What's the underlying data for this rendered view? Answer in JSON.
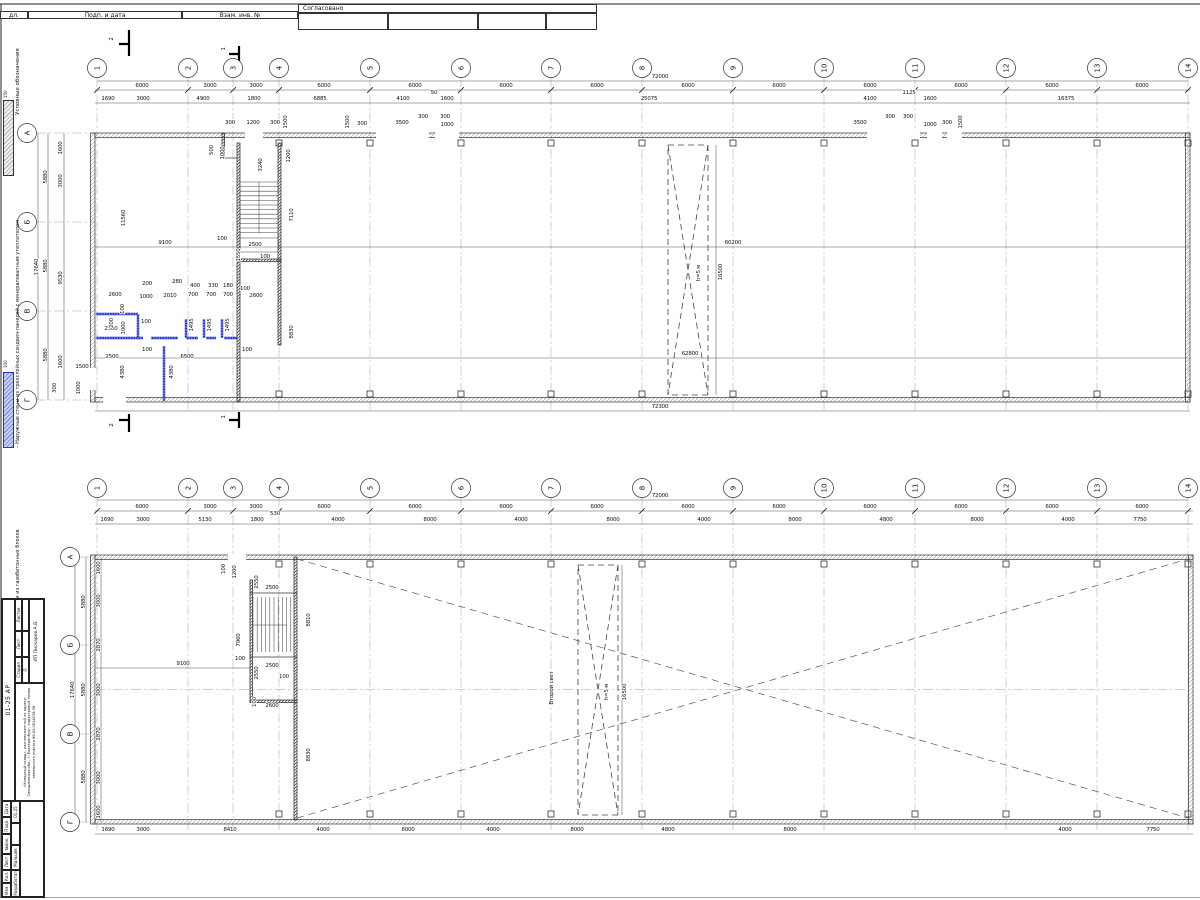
{
  "header": {
    "c1": "дл.",
    "c2": "Подп. и дата",
    "c3": "Взам. инв. №",
    "c4": "Согласовано"
  },
  "legend": {
    "title": "Условные обозначения",
    "item1": "– Наружные стены из трехслойных сэндвич-панелей с минераловатным утеплителем",
    "item2": "– Внутренние перегородки из газобетонных блоков",
    "t1": "150",
    "t2": "100",
    "blue": "#2330d8"
  },
  "titleblock": {
    "columns": [
      "Изм.",
      "Кол.",
      "Лист",
      "№док.",
      "Подп.",
      "Дата"
    ],
    "role": "Разработал",
    "name": "Мальцев",
    "date": "01.25",
    "doc_code": "01-25 АР",
    "project": "«Холодный склад», расположенный по адресу: Свердловская обл., г. Екатеринбург, кадастровый номер земельного участка 66:41:0614035:36",
    "client": "ИП Пискарев А.В.",
    "stage_label": "Стадия",
    "sheet_label": "Лист",
    "sheets_label": "Листов",
    "stage": "П"
  },
  "plan1": {
    "circles_top": [
      [
        "1",
        97,
        68
      ],
      [
        "2",
        188,
        68
      ],
      [
        "3",
        233,
        68
      ],
      [
        "4",
        279,
        68
      ],
      [
        "5",
        370,
        68
      ],
      [
        "6",
        461,
        68
      ],
      [
        "7",
        551,
        68
      ],
      [
        "8",
        642,
        68
      ],
      [
        "9",
        733,
        68
      ],
      [
        "10",
        824,
        68
      ],
      [
        "11",
        915,
        68
      ],
      [
        "12",
        1006,
        68
      ],
      [
        "13",
        1097,
        68
      ],
      [
        "14",
        1188,
        68
      ]
    ],
    "circles_left": [
      [
        "А",
        27,
        133
      ],
      [
        "Б",
        27,
        222
      ],
      [
        "В",
        27,
        311
      ],
      [
        "Г",
        27,
        400
      ]
    ],
    "total_top": [
      [
        "72000",
        660,
        78
      ]
    ],
    "dims1": [
      [
        "6000",
        142,
        87
      ],
      [
        "3000",
        210,
        87
      ],
      [
        "3000",
        256,
        87
      ],
      [
        "6000",
        324,
        87
      ],
      [
        "6000",
        415,
        87
      ],
      [
        "6000",
        506,
        87
      ],
      [
        "6000",
        597,
        87
      ],
      [
        "6000",
        688,
        87
      ],
      [
        "6000",
        779,
        87
      ],
      [
        "6000",
        870,
        87
      ],
      [
        "6000",
        961,
        87
      ],
      [
        "6000",
        1052,
        87
      ],
      [
        "6000",
        1142,
        87
      ]
    ],
    "dims2": [
      [
        "1690",
        108,
        100
      ],
      [
        "3000",
        143,
        100
      ],
      [
        "4900",
        203,
        100
      ],
      [
        "1800",
        254,
        100
      ],
      [
        "6885",
        320,
        100
      ],
      [
        "4100",
        403,
        100
      ],
      [
        "50",
        434,
        94
      ],
      [
        "1600",
        447,
        100
      ],
      [
        "25075",
        649,
        100
      ],
      [
        "4100",
        870,
        100
      ],
      [
        "1125",
        909,
        94
      ],
      [
        "1600",
        930,
        100
      ],
      [
        "16375",
        1066,
        100
      ]
    ],
    "left_dims": [
      [
        "17640",
        38,
        267,
        1
      ],
      [
        "5880",
        47,
        177,
        1
      ],
      [
        "5880",
        47,
        266,
        1
      ],
      [
        "5880",
        47,
        355,
        1
      ],
      [
        "1600",
        62,
        148,
        1
      ],
      [
        "3000",
        62,
        181,
        1
      ],
      [
        "9530",
        62,
        278,
        1
      ],
      [
        "1600",
        62,
        362,
        1
      ]
    ],
    "ann": [
      [
        "300",
        230,
        124
      ],
      [
        "1200",
        253,
        124
      ],
      [
        "300",
        275,
        124
      ],
      [
        "1500",
        287,
        122,
        1
      ],
      [
        "1500",
        349,
        122,
        1
      ],
      [
        "300",
        362,
        125
      ],
      [
        "3500",
        402,
        124
      ],
      [
        "300",
        423,
        118
      ],
      [
        "300",
        445,
        118
      ],
      [
        "1000",
        447,
        126
      ],
      [
        "500",
        213,
        150,
        1
      ],
      [
        "1000",
        224,
        153,
        1
      ],
      [
        "3240",
        262,
        165,
        1
      ],
      [
        "1200",
        290,
        156,
        1
      ],
      [
        "7110",
        293,
        215,
        1
      ],
      [
        "100",
        222,
        240
      ],
      [
        "2500",
        255,
        246
      ],
      [
        "1550",
        240,
        255,
        1
      ],
      [
        "100",
        265,
        258
      ],
      [
        "9100",
        165,
        244
      ],
      [
        "11560",
        125,
        218,
        1
      ],
      [
        "200",
        147,
        285
      ],
      [
        "280",
        177,
        283
      ],
      [
        "400",
        195,
        287
      ],
      [
        "330",
        213,
        287
      ],
      [
        "180",
        228,
        287
      ],
      [
        "100",
        245,
        290
      ],
      [
        "2600",
        115,
        296
      ],
      [
        "1000",
        146,
        298
      ],
      [
        "2010",
        170,
        297
      ],
      [
        "700",
        193,
        296
      ],
      [
        "700",
        211,
        296
      ],
      [
        "700",
        228,
        296
      ],
      [
        "2600",
        256,
        297
      ],
      [
        "2500",
        111,
        330
      ],
      [
        "100",
        124,
        309,
        1
      ],
      [
        "200",
        113,
        323,
        1
      ],
      [
        "1000",
        125,
        328,
        1
      ],
      [
        "100",
        146,
        323
      ],
      [
        "1495",
        193,
        325,
        1
      ],
      [
        "1495",
        211,
        325,
        1
      ],
      [
        "1495",
        229,
        325,
        1
      ],
      [
        "100",
        147,
        351
      ],
      [
        "100",
        247,
        351
      ],
      [
        "2500",
        112,
        358
      ],
      [
        "6500",
        187,
        358
      ],
      [
        "4380",
        124,
        372,
        1
      ],
      [
        "4380",
        173,
        372,
        1
      ],
      [
        "8830",
        293,
        332,
        1
      ],
      [
        "1500",
        82,
        368
      ],
      [
        "300",
        56,
        388,
        1
      ],
      [
        "1000",
        80,
        388,
        1
      ],
      [
        "3500",
        860,
        124
      ],
      [
        "300",
        890,
        118
      ],
      [
        "300",
        908,
        118
      ],
      [
        "1000",
        930,
        126
      ],
      [
        "300",
        947,
        124
      ],
      [
        "1500",
        962,
        122,
        1
      ],
      [
        "60200",
        733,
        244
      ],
      [
        "16500",
        722,
        272,
        1
      ],
      [
        "62800",
        690,
        355
      ],
      [
        "h=5 м",
        700,
        273,
        1
      ]
    ],
    "total_bottom": [
      [
        "72300",
        660,
        408
      ]
    ],
    "sections": [
      [
        "2",
        113,
        39,
        1
      ],
      [
        "1",
        225,
        49,
        1
      ],
      [
        "2",
        113,
        425,
        1
      ],
      [
        "1",
        225,
        417,
        1
      ]
    ]
  },
  "plan2": {
    "circles_top": [
      [
        "1",
        97,
        488
      ],
      [
        "2",
        188,
        488
      ],
      [
        "3",
        233,
        488
      ],
      [
        "4",
        279,
        488
      ],
      [
        "5",
        370,
        488
      ],
      [
        "6",
        461,
        488
      ],
      [
        "7",
        551,
        488
      ],
      [
        "8",
        642,
        488
      ],
      [
        "9",
        733,
        488
      ],
      [
        "10",
        824,
        488
      ],
      [
        "11",
        915,
        488
      ],
      [
        "12",
        1006,
        488
      ],
      [
        "13",
        1097,
        488
      ],
      [
        "14",
        1188,
        488
      ]
    ],
    "circles_left": [
      [
        "А",
        70,
        557
      ],
      [
        "Б",
        70,
        645
      ],
      [
        "В",
        70,
        734
      ],
      [
        "Г",
        70,
        822
      ]
    ],
    "total_top": [
      [
        "72000",
        660,
        497
      ]
    ],
    "dims1": [
      [
        "6000",
        142,
        508
      ],
      [
        "3000",
        210,
        508
      ],
      [
        "3000",
        256,
        508
      ],
      [
        "6000",
        324,
        508
      ],
      [
        "6000",
        415,
        508
      ],
      [
        "6000",
        506,
        508
      ],
      [
        "6000",
        597,
        508
      ],
      [
        "6000",
        688,
        508
      ],
      [
        "6000",
        779,
        508
      ],
      [
        "6000",
        870,
        508
      ],
      [
        "6000",
        961,
        508
      ],
      [
        "6000",
        1052,
        508
      ],
      [
        "6000",
        1142,
        508
      ]
    ],
    "dims2": [
      [
        "1690",
        107,
        521
      ],
      [
        "3000",
        143,
        521
      ],
      [
        "5130",
        205,
        521
      ],
      [
        "1800",
        257,
        521
      ],
      [
        "530",
        275,
        515
      ],
      [
        "4000",
        338,
        521
      ],
      [
        "8000",
        430,
        521
      ],
      [
        "4000",
        521,
        521
      ],
      [
        "8000",
        613,
        521
      ],
      [
        "4000",
        704,
        521
      ],
      [
        "8000",
        795,
        521
      ],
      [
        "4800",
        886,
        521
      ],
      [
        "8000",
        977,
        521
      ],
      [
        "4000",
        1068,
        521
      ],
      [
        "7750",
        1140,
        521
      ]
    ],
    "left_dims": [
      [
        "17640",
        74,
        690,
        1
      ],
      [
        "5880",
        85,
        602,
        1
      ],
      [
        "5880",
        85,
        690,
        1
      ],
      [
        "5880",
        85,
        777,
        1
      ],
      [
        "1600",
        100,
        568,
        1
      ],
      [
        "3000",
        100,
        601,
        1
      ],
      [
        "2870",
        100,
        645,
        1
      ],
      [
        "3000",
        100,
        690,
        1
      ],
      [
        "2870",
        100,
        734,
        1
      ],
      [
        "3000",
        100,
        778,
        1
      ],
      [
        "1600",
        100,
        812,
        1
      ]
    ],
    "ann": [
      [
        "100",
        225,
        569,
        1
      ],
      [
        "1200",
        236,
        572,
        1
      ],
      [
        "2550",
        258,
        582,
        1
      ],
      [
        "2500",
        272,
        589
      ],
      [
        "7960",
        240,
        640,
        1
      ],
      [
        "100",
        240,
        660
      ],
      [
        "2500",
        272,
        667
      ],
      [
        "2550",
        258,
        673,
        1
      ],
      [
        "100",
        284,
        678
      ],
      [
        "2600",
        272,
        707
      ],
      [
        "100",
        256,
        702,
        1
      ],
      [
        "9100",
        183,
        665
      ],
      [
        "8810",
        310,
        620,
        1
      ],
      [
        "8830",
        310,
        755,
        1
      ],
      [
        "Второй свет",
        553,
        688,
        1
      ],
      [
        "h=5 м",
        608,
        692,
        1
      ],
      [
        "16500",
        626,
        692,
        1
      ]
    ],
    "dims_bottom": [
      [
        "1690",
        108,
        831
      ],
      [
        "3000",
        143,
        831
      ],
      [
        "8410",
        230,
        831
      ],
      [
        "4000",
        323,
        831
      ],
      [
        "8000",
        408,
        831
      ],
      [
        "4000",
        493,
        831
      ],
      [
        "8000",
        577,
        831
      ],
      [
        "4800",
        668,
        831
      ],
      [
        "8000",
        790,
        831
      ],
      [
        "4000",
        1065,
        831
      ],
      [
        "7750",
        1153,
        831
      ]
    ]
  }
}
